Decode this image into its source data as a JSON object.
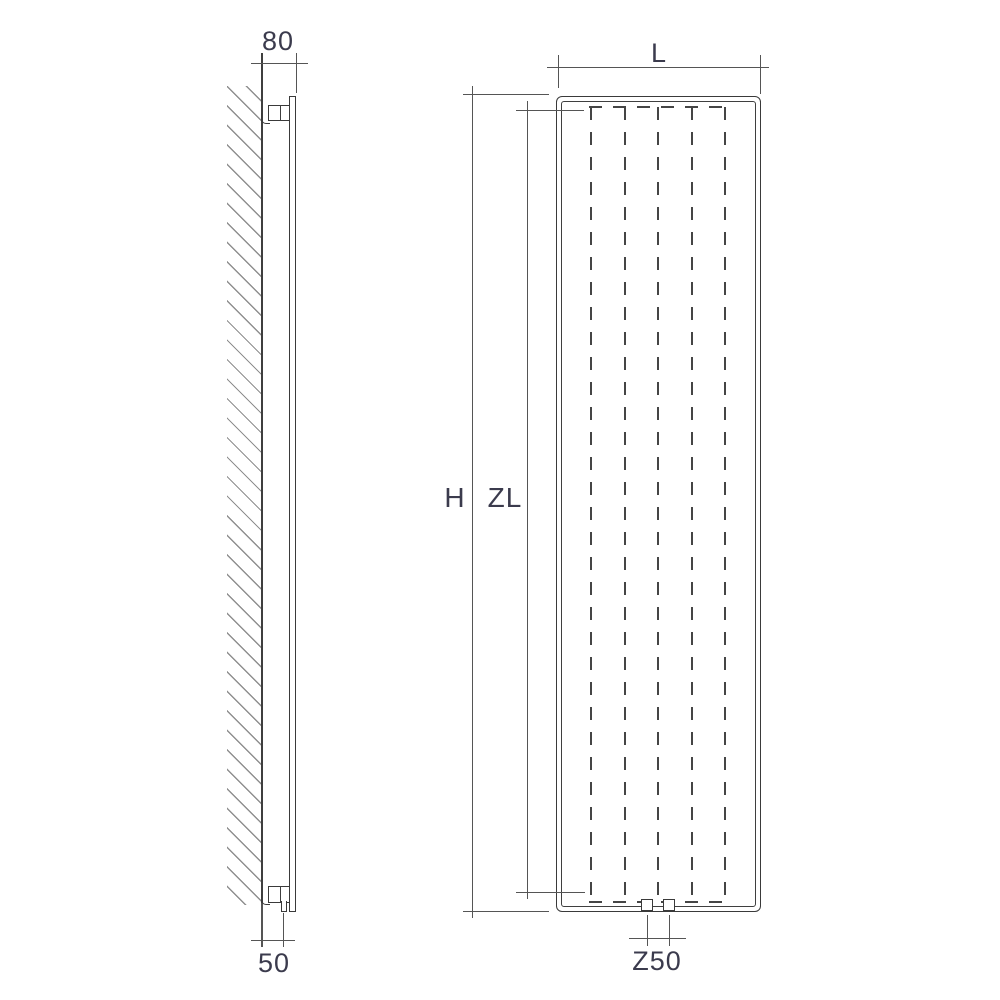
{
  "drawing": {
    "type": "technical-dimension-diagram",
    "subject": "vertical panel radiator — side view (wall mounted) and front view",
    "side_view": {
      "top_dimension_label": "80",
      "bottom_dimension_label": "50"
    },
    "front_view": {
      "width_dimension_label": "L",
      "height_dimension_label": "H",
      "zl_dimension_label": "ZL",
      "connection_dimension_label": "Z50"
    },
    "colors": {
      "background": "#ffffff",
      "object_line": "#3a3a3a",
      "dimension_line": "#555555",
      "dashed_line": "#454545",
      "hatch_line": "#8f8f8f",
      "label_text": "#3b3b4d"
    }
  }
}
